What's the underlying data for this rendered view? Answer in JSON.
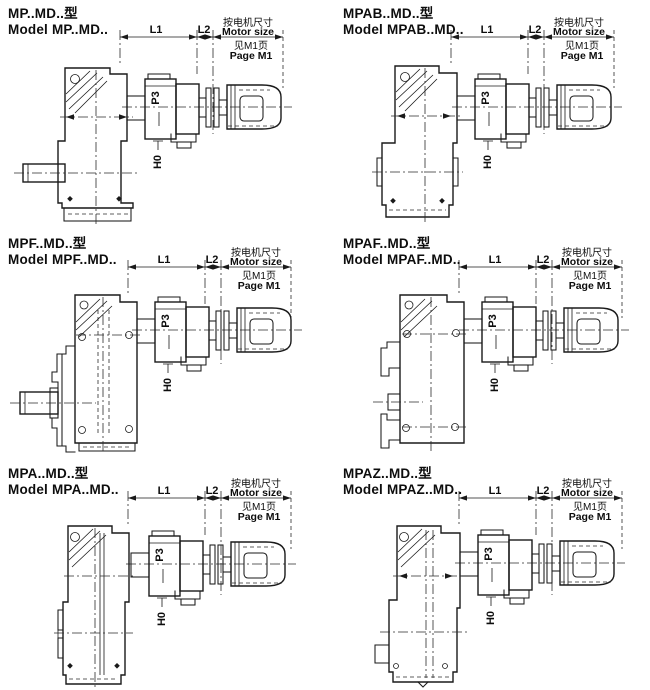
{
  "page": {
    "background": "#ffffff",
    "line_color": "#1a1a1a"
  },
  "labels": {
    "l1": "L1",
    "l2": "L2",
    "p3": "P3",
    "h0": "H0",
    "motor_note_cn": "按电机尺寸",
    "motor_note_en": "Motor size",
    "page_ref_cn": "见M1页",
    "page_ref_en": "Page M1"
  },
  "panels": [
    {
      "title_cn": "MP..MD..型",
      "title_en": "Model MP..MD.."
    },
    {
      "title_cn": "MPAB..MD..型",
      "title_en": "Model MPAB..MD.."
    },
    {
      "title_cn": "MPF..MD..型",
      "title_en": "Model MPF..MD.."
    },
    {
      "title_cn": "MPAF..MD..型",
      "title_en": "Model MPAF..MD.."
    },
    {
      "title_cn": "MPA..MD..型",
      "title_en": "Model MPA..MD.."
    },
    {
      "title_cn": "MPAZ..MD..型",
      "title_en": "Model MPAZ..MD.."
    }
  ]
}
